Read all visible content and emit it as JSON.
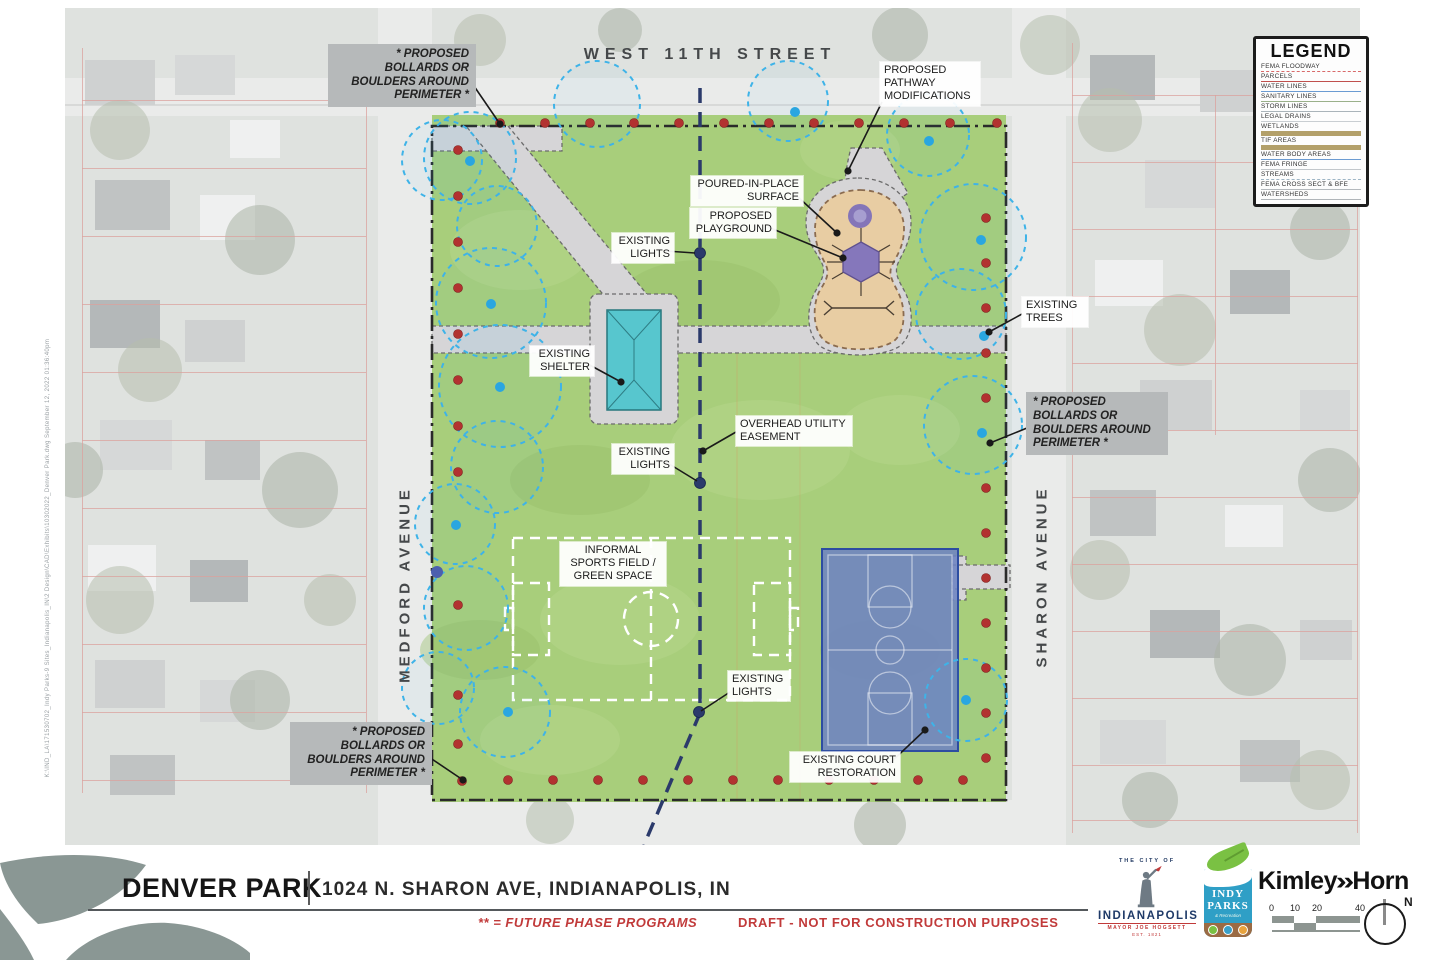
{
  "streets": {
    "west11th": "WEST 11TH STREET",
    "medford": "MEDFORD AVENUE",
    "sharon": "SHARON AVENUE"
  },
  "legend": {
    "title": "LEGEND",
    "items": [
      {
        "label": "FEMA FLOODWAY",
        "color": "#d86a6a",
        "style": "dashed"
      },
      {
        "label": "PARCELS",
        "color": "#c0504d",
        "style": "solid"
      },
      {
        "label": "WATER LINES",
        "color": "#6b9bd2",
        "style": "solid"
      },
      {
        "label": "SANITARY LINES",
        "color": "#9ab08a",
        "style": "solid"
      },
      {
        "label": "STORM LINES",
        "color": "#aab4ba",
        "style": "solid"
      },
      {
        "label": "LEGAL DRAINS",
        "color": "#c9ced2",
        "style": "solid"
      },
      {
        "label": "WETLANDS",
        "color": "#b3a06a",
        "style": "thick"
      },
      {
        "label": "TIF AREAS",
        "color": "#b3a06a",
        "style": "thick"
      },
      {
        "label": "WATER BODY AREAS",
        "color": "#6b9bd2",
        "style": "solid"
      },
      {
        "label": "FEMA FRINGE",
        "color": "#c2c7cb",
        "style": "solid"
      },
      {
        "label": "STREAMS",
        "color": "#9fb6c6",
        "style": "dashed"
      },
      {
        "label": "FEMA CROSS SECT & BFE",
        "color": "#b4b9bd",
        "style": "solid"
      },
      {
        "label": "WATERSHEDS",
        "color": "#b0b5b9",
        "style": "solid"
      }
    ]
  },
  "annotations": {
    "bollards_note": "* PROPOSED BOLLARDS OR BOULDERS AROUND PERIMETER *",
    "pathway_mods": "PROPOSED PATHWAY MODIFICATIONS",
    "poured_in_place": "POURED-IN-PLACE SURFACE",
    "proposed_playground": "PROPOSED PLAYGROUND",
    "existing_lights": "EXISTING LIGHTS",
    "existing_trees": "EXISTING TREES",
    "existing_shelter": "EXISTING SHELTER",
    "overhead_easement": "OVERHEAD UTILITY EASEMENT",
    "sports_field": "INFORMAL SPORTS FIELD / GREEN SPACE",
    "court_restoration": "EXISTING COURT RESTORATION"
  },
  "titleblock": {
    "park_name": "DENVER PARK",
    "address": "1024 N. SHARON AVE, INDIANAPOLIS, IN",
    "future_note": "** = FUTURE PHASE PROGRAMS",
    "draft_note": "DRAFT - NOT FOR CONSTRUCTION PURPOSES"
  },
  "logos": {
    "indianapolis": {
      "top": "THE CITY OF",
      "name": "INDIANAPOLIS",
      "mayor": "MAYOR JOE HOGSETT",
      "est": "EST. 1821"
    },
    "indy_parks": {
      "line1": "INDY",
      "line2": "PARKS",
      "line3": "& Recreation"
    },
    "kimley_horn": {
      "left": "Kimley",
      "chevron": "»",
      "right": "Horn"
    }
  },
  "scalebar": {
    "labels": [
      "0",
      "10",
      "20",
      "40"
    ]
  },
  "north_label": "N",
  "meta": {
    "file_note": "K:\\IND_LA\\171530702_Indy Parks-9 Sites_Indianapolis_IN\\2 Design\\CAD\\Exhibits\\10302022_Denver Park.dwg     September 12, 2022  01:36:40pm"
  },
  "colors": {
    "park_green": "#a8ce7b",
    "path_gray": "#d6d5d7",
    "playground_tan": "#e8cda3",
    "playground_purple": "#8577bb",
    "shelter_teal": "#57c6ce",
    "court_blue": "#6d83c2",
    "bollard_red": "#b23230",
    "tree_cyan": "#2aa6e0",
    "easement_navy": "#2b3a6b",
    "boundary_black": "#2a2a2a",
    "accent_red": "#c13a3a"
  }
}
